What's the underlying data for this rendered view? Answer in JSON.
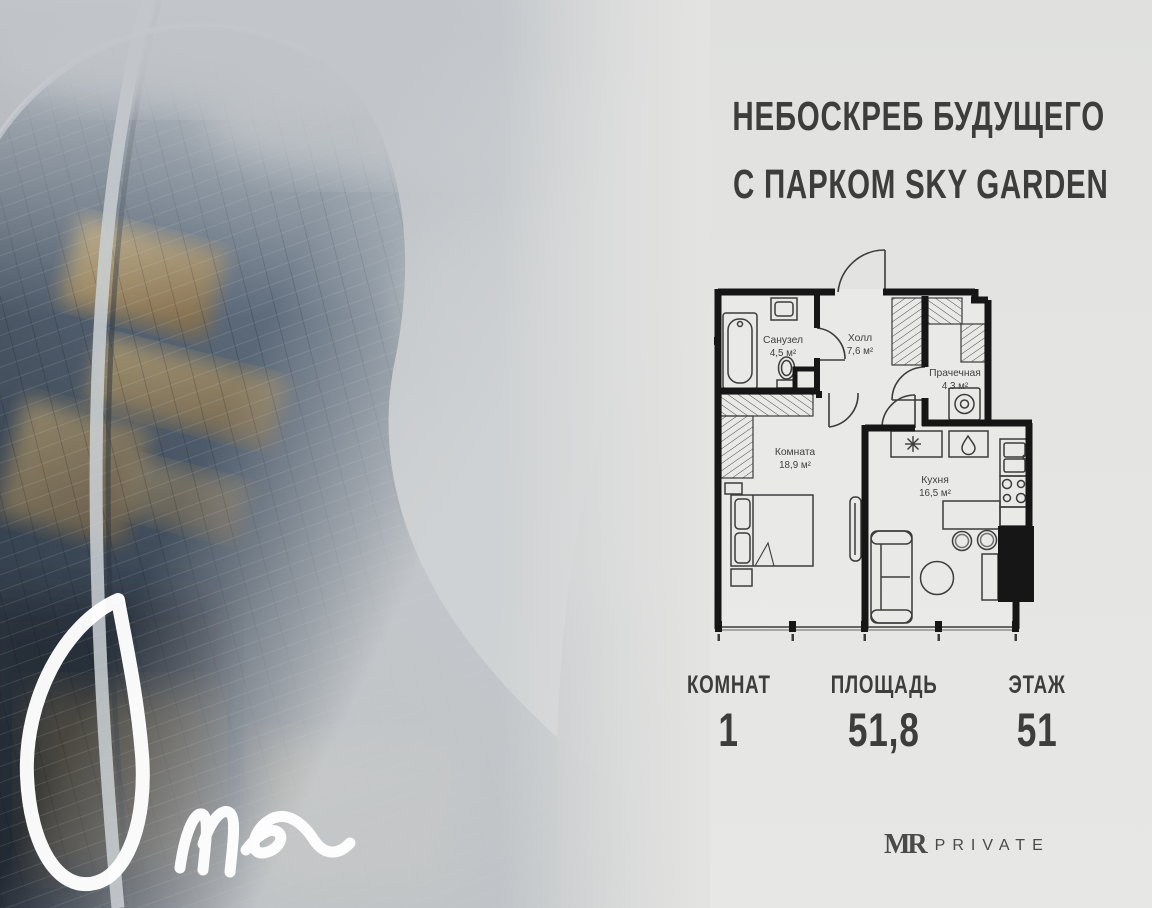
{
  "page": {
    "width": 1152,
    "height": 908,
    "background": "#e3e3e1"
  },
  "header": {
    "line1": "НЕБОСКРЕБ БУДУЩЕГО",
    "line2": "С ПАРКОМ SKY GARDEN",
    "color": "#3d3d3b"
  },
  "floorplan": {
    "rooms": [
      {
        "name": "Санузел",
        "area": "4,5 м²"
      },
      {
        "name": "Холл",
        "area": "7,6 м²"
      },
      {
        "name": "Прачечная",
        "area": "4,3 м²"
      },
      {
        "name": "Комната",
        "area": "18,9 м²"
      },
      {
        "name": "Кухня",
        "area": "16,5 м²"
      }
    ],
    "wall_color": "#161616"
  },
  "stats": [
    {
      "label": "КОМНАТ",
      "value": "1"
    },
    {
      "label": "ПЛОЩАДЬ",
      "value": "51,8"
    },
    {
      "label": "ЭТАЖ",
      "value": "51"
    }
  ],
  "branding": {
    "logo_mr": "MR",
    "logo_word": "PRIVATE",
    "script_word": "One"
  },
  "colors": {
    "text": "#3d3d3b",
    "gold": "#c2974f",
    "fog": "#c9ccce",
    "glass_dark": "#232b36"
  }
}
